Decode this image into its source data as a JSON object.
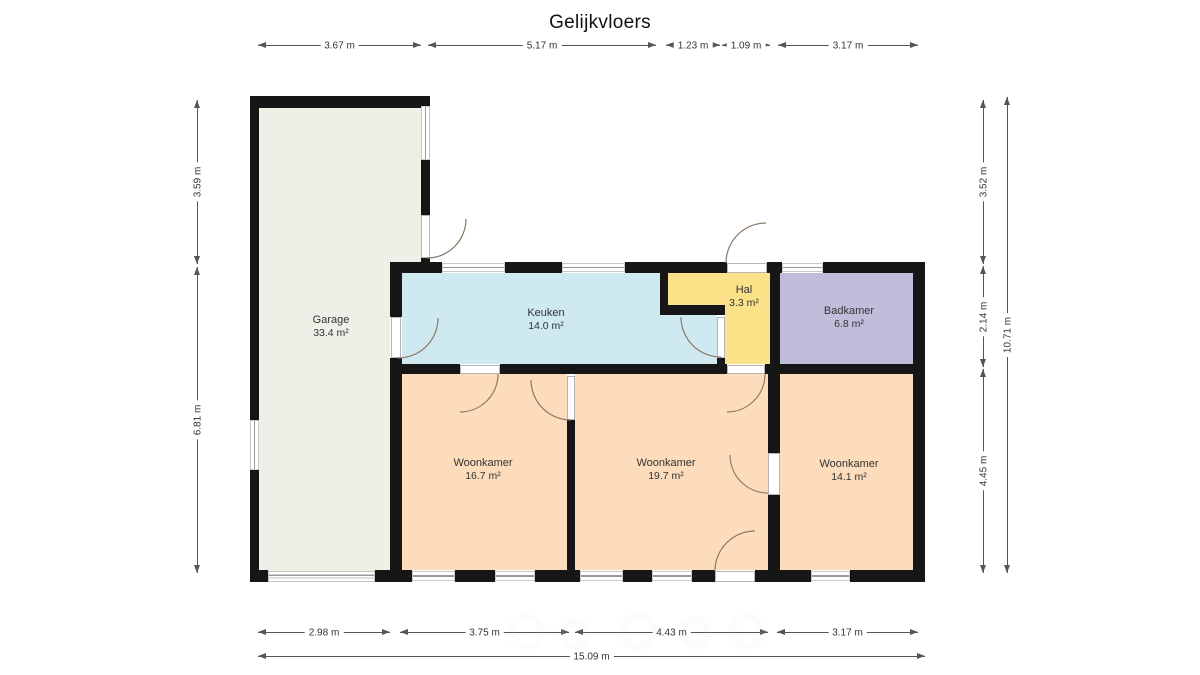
{
  "title": "Gelijkvloers",
  "rooms": {
    "garage": {
      "name": "Garage",
      "area": "33.4 m²"
    },
    "keuken": {
      "name": "Keuken",
      "area": "14.0 m²"
    },
    "hal": {
      "name": "Hal",
      "area": "3.3 m²"
    },
    "badkamer": {
      "name": "Badkamer",
      "area": "6.8 m²"
    },
    "woonkamer1": {
      "name": "Woonkamer",
      "area": "16.7 m²"
    },
    "woonkamer2": {
      "name": "Woonkamer",
      "area": "19.7 m²"
    },
    "woonkamer3": {
      "name": "Woonkamer",
      "area": "14.1 m²"
    }
  },
  "dimensions": {
    "top": [
      "3.67 m",
      "5.17 m",
      "1.23 m",
      "1.09 m",
      "3.17 m"
    ],
    "bottom": [
      "2.98 m",
      "3.75 m",
      "4.43 m",
      "3.17 m"
    ],
    "bottom_total": "15.09 m",
    "left": [
      "3.59 m",
      "6.81 m"
    ],
    "right": [
      "3.52 m",
      "2.14 m",
      "4.45 m"
    ],
    "right_total": "10.71 m"
  },
  "colors": {
    "wall": "#161616",
    "garage_floor": "#f0efe7",
    "keuken_floor": "#cfe9f0",
    "hal_floor": "#fbe289",
    "badkamer_floor": "#bfbdda",
    "woonkamer_floor": "#fcdcba",
    "dimension_line": "#555555"
  }
}
